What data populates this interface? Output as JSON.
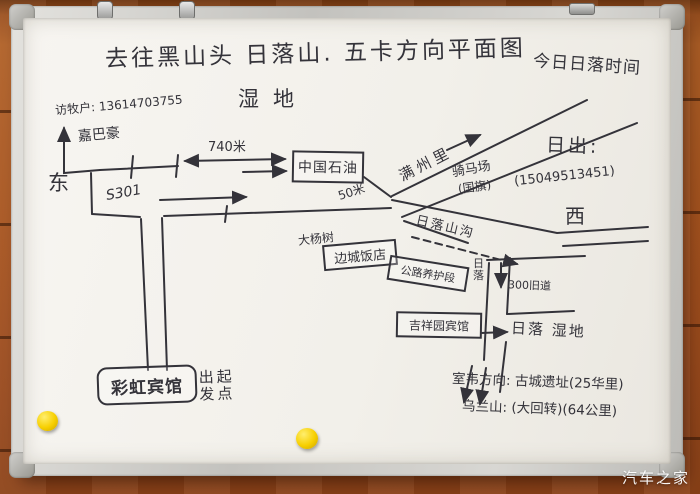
{
  "watermark": "汽车之家",
  "board": {
    "title": "去往黑山头 日落山. 五卡方向平面图",
    "subtitle": "湿地",
    "sunset_time_note": "今日日落时间",
    "sunrise_label": "日出:",
    "phone_sunrise": "(15049513451)",
    "west": "西",
    "east": "东",
    "herder_note": "访牧户: 13614703755",
    "guesthouse_north": "嘉巴豪",
    "road_label": "S301",
    "dist_740m": "740米",
    "petro": "中国石油",
    "dist_50m": "50米",
    "manzhouli": "满州里",
    "horse_ranch": "骑马场",
    "horse_ranch_note": "(国旗)",
    "sunset_gully": "日落山沟",
    "poplar": "大杨树",
    "biancheng_hotel": "边城饭店",
    "road_maintenance": "公路养护段",
    "sunset_vertical": "日落",
    "old_road": "300旧道",
    "jixiang_hotel": "吉祥园宾馆",
    "sunset_wetland": "日落 湿地",
    "rainbow_hotel": "彩虹宾馆",
    "start_col_1": "出发",
    "start_col_2": "起点",
    "shiwei_direction": "室韦方向: 古城遗址(25华里)",
    "wulan_mountain": "乌兰山: (大回转)(64公里)"
  }
}
